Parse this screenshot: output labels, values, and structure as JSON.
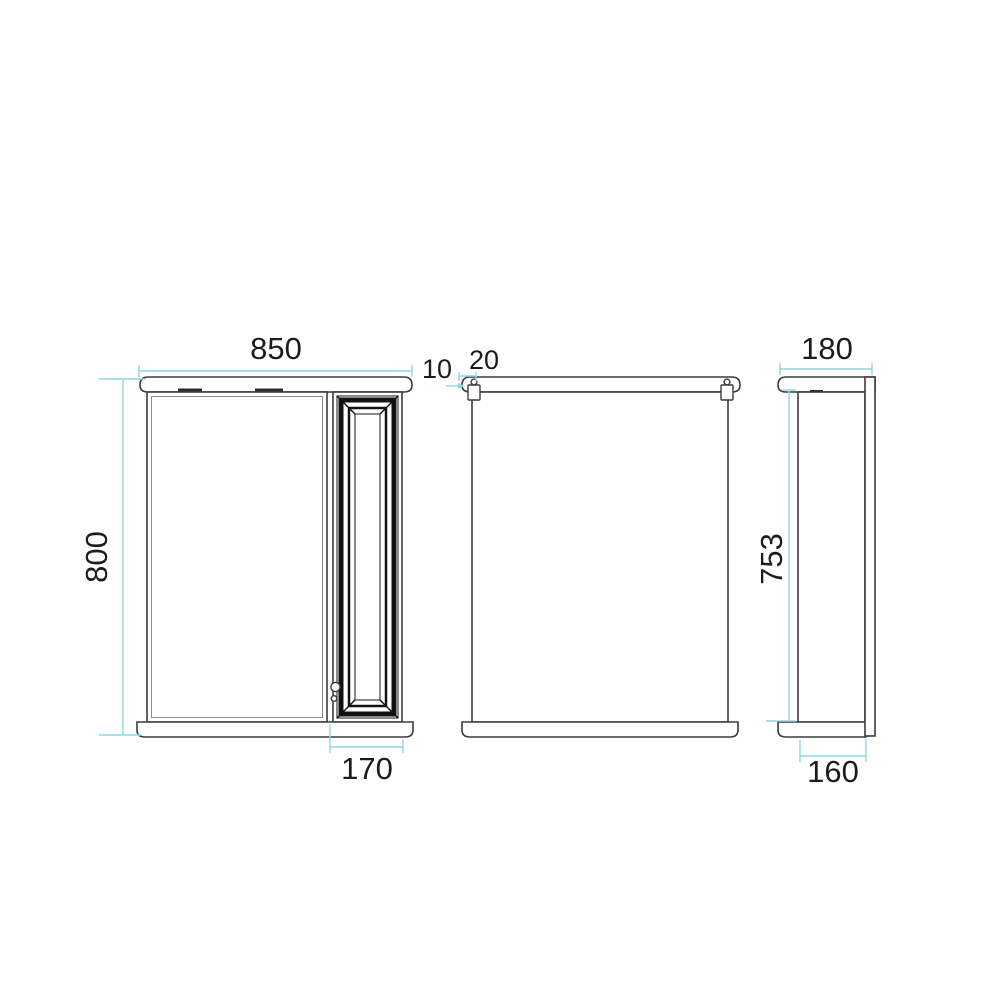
{
  "drawing": {
    "type": "technical-dimension-drawing",
    "subject": "mirror-cabinet three orthographic views",
    "colors": {
      "outline": "#3c3c3c",
      "door_frame": "#111111",
      "dimension_lines": "#8fd8e2",
      "text": "#1c1c1c",
      "background": "#ffffff"
    },
    "views": {
      "front": {
        "width_label": "850",
        "height_label": "800",
        "door_width_label": "170"
      },
      "back": {
        "hanger_top_offset_label": "10",
        "hanger_side_offset_label": "20",
        "body_height_label": "753"
      },
      "side": {
        "depth_label": "180",
        "base_depth_label": "160"
      }
    }
  }
}
